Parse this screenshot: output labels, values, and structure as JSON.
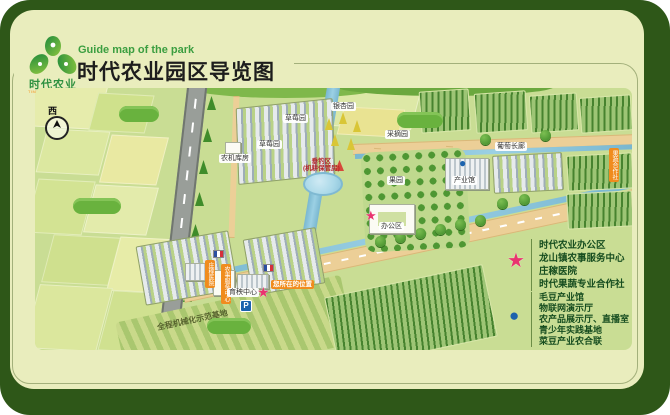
{
  "header": {
    "subtitle_en": "Guide map of the park",
    "title": "时代农业园区导览图",
    "logo_name": "时代农业",
    "logo_sub": "TIMES AGRICULTURE"
  },
  "map": {
    "compass": "西",
    "labels": {
      "strawberry_a": "草莓园",
      "strawberry_b": "草莓园",
      "machine_shed": "农机库房",
      "ginkgo": "银杏园",
      "fishing": "垂钓区",
      "fishing_sub": "(机耕保管房)",
      "picking": "采摘园",
      "orchard": "果园",
      "industry_hall": "产业馆",
      "grape_corridor": "葡萄长廊",
      "coop_tag": "果蔬合作社",
      "office": "办公区",
      "hospital_tag": "庄稼医院",
      "service_tag": "农事服务中心",
      "seedling": "育秧中心",
      "you_are_here": "您所在的位置",
      "parking": "P",
      "mech_base": "全程机械化示范基地"
    }
  },
  "legend": {
    "star_symbol": "★",
    "star_items": [
      "时代农业办公区",
      "龙山镇农事服务中心",
      "庄稼医院",
      "时代果蔬专业合作社"
    ],
    "dot_symbol": "●",
    "dot_items": [
      "毛豆产业馆",
      "物联网演示厅",
      "农产品展示厅、直播室",
      "青少年实践基地",
      "菜豆产业农合联"
    ]
  },
  "colors": {
    "frame_green": "#2e5718",
    "panel_cream": "#e9edbd",
    "map_green": "#c9dd94",
    "title_green": "#3b9e40",
    "accent_star": "#e9346f",
    "accent_dot": "#1c63ad",
    "highlight_orange": "#f08c1e"
  }
}
